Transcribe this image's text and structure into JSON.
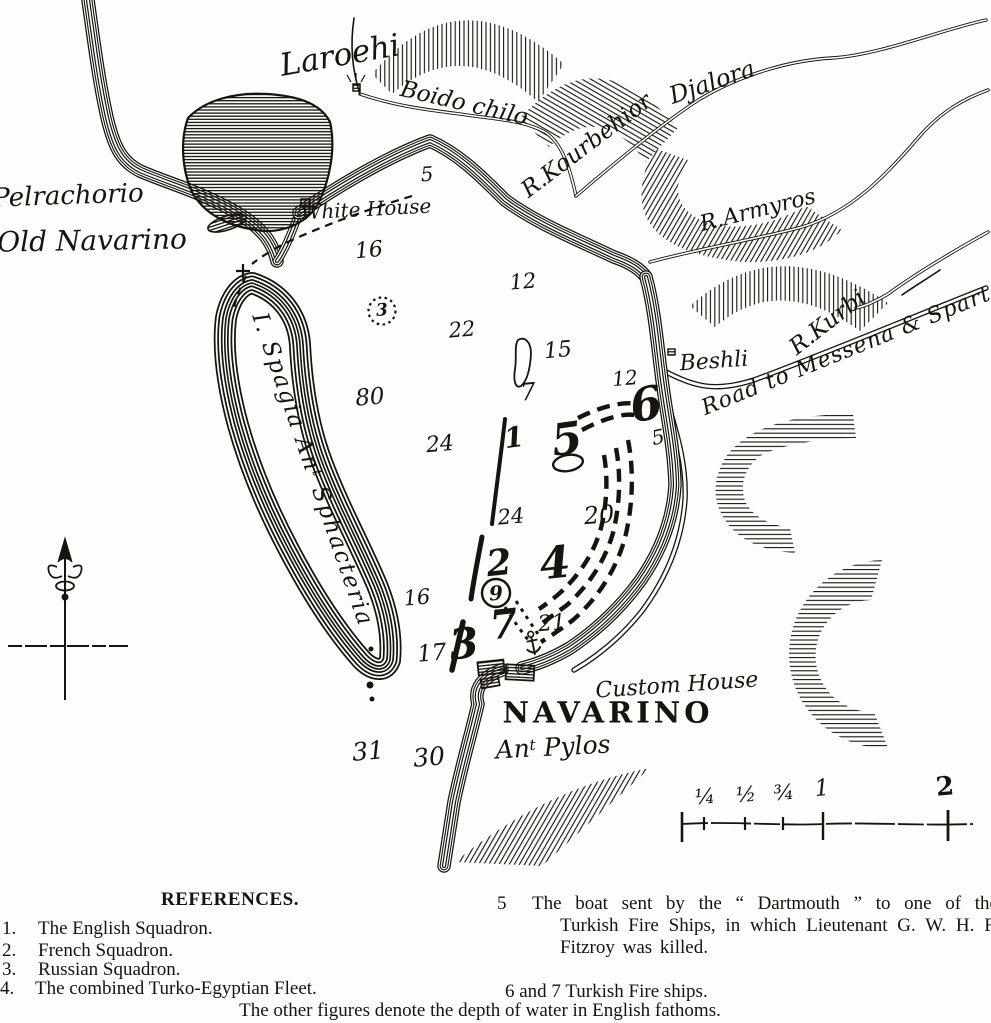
{
  "map": {
    "place_labels": {
      "pelrachorio": "Pelrachorio",
      "old_navarino": "Old Navarino",
      "laroehi": "Laroehi",
      "boido_chilo": "Boido chilo",
      "r_kourbehior": "R.Kourbehior",
      "djalora": "Djalora",
      "r_armyros": "R.Armyros",
      "r_kurbi": "R.Kurbi",
      "road_to_messena": "Road to Messena & Sparta",
      "beshli": "Beshli",
      "white_house": "White House",
      "custom_house": "Custom House",
      "navarino": "NAVARINO",
      "ant_pylos": {
        "base": "An",
        "sup": "t",
        "rest": " Pylos"
      },
      "sphacteria_island": {
        "base": "I. Spagia An",
        "sup": "t",
        "rest": " Sphacteria"
      }
    },
    "position_markers": [
      {
        "id": "english-squadron",
        "label": "1"
      },
      {
        "id": "french-squadron",
        "label": "2"
      },
      {
        "id": "russian-squadron",
        "label": "3"
      },
      {
        "id": "turko-egyptian-fleet",
        "label": "4"
      },
      {
        "id": "dartmouth-boat",
        "label": "5"
      },
      {
        "id": "fire-ship-6",
        "label": "6"
      },
      {
        "id": "fire-ship-7",
        "label": "7"
      },
      {
        "id": "rock-circle",
        "label": "9"
      },
      {
        "id": "anchorage-dotted-circle",
        "label": "3"
      }
    ],
    "depth_soundings": [
      "5",
      "16",
      "12",
      "22",
      "15",
      "7",
      "80",
      "24",
      "12",
      "5",
      "24",
      "20",
      "16",
      "17",
      "21",
      "31",
      "30"
    ]
  },
  "scale_bar": {
    "tick_labels": [
      "¼",
      "½",
      "¾",
      "1",
      "2"
    ]
  },
  "references": {
    "heading": "REFERENCES.",
    "items": [
      {
        "num": "1.",
        "text": "The English Squadron."
      },
      {
        "num": "2.",
        "text": "French Squadron."
      },
      {
        "num": "3.",
        "text": "Russian Squadron."
      },
      {
        "num": "4.",
        "text": "The combined Turko-Egyptian Fleet."
      }
    ],
    "item5_num": "5",
    "item5_text": "The boat sent by the “ Dartmouth ” to one of the Turkish Fire Ships, in which Lieutenant G. W. H. F. Fitzroy was killed.",
    "item6_7": "6 and 7   Turkish Fire ships.",
    "footnote": "The other figures denote the depth of water in English fathoms."
  },
  "colors": {
    "ink": "#17130e",
    "paper": "#fdfdfb"
  }
}
